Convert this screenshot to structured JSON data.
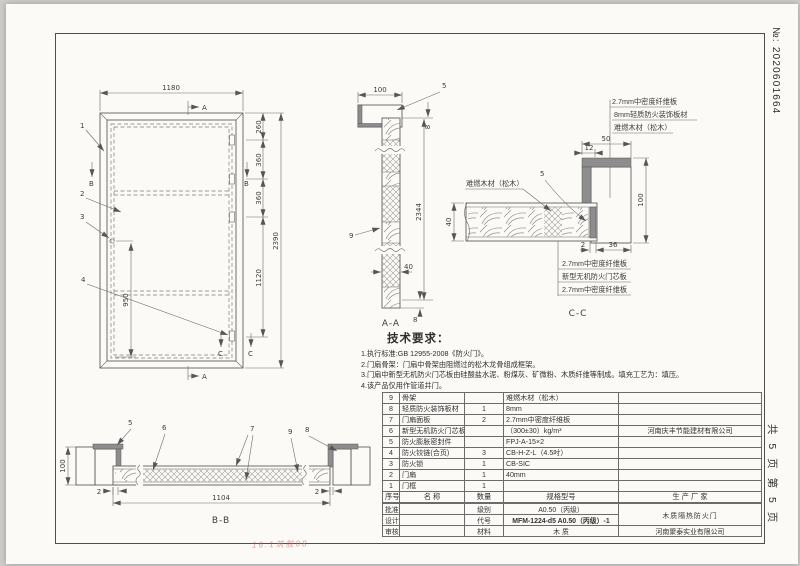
{
  "meta": {
    "doc_no": "№: 2020601664",
    "page_info": "共 5 页  第 5 页",
    "note": "16.1筑胶08"
  },
  "elev": {
    "w": "1180",
    "h": "2390",
    "s1": "260",
    "s2": "360",
    "s3": "360",
    "s4": "1120",
    "lock": "950",
    "n1": "1",
    "n2": "2",
    "n3": "3",
    "n4": "4",
    "a": "A",
    "b": "B",
    "c": "C"
  },
  "aa": {
    "label": "A-A",
    "w": "100",
    "h": "2344",
    "t": "40",
    "gap": "8",
    "n5": "5",
    "n9": "9"
  },
  "cc": {
    "label": "C-C",
    "top1": "2.7mm中密度纤维板",
    "top2": "8mm轻质防火装饰板材",
    "top3": "难燃木材（松木）",
    "left": "难燃木材（松木）",
    "bot1": "2.7mm中密度纤维板",
    "bot2": "新型无机防火门芯板",
    "bot3": "2.7mm中密度纤维板",
    "d50": "50",
    "d12": "12",
    "d100": "100",
    "d40": "40",
    "d2": "2",
    "d36": "36",
    "n5": "5"
  },
  "bb": {
    "label": "B-B",
    "d100": "100",
    "d2l": "2",
    "d2r": "2",
    "d1104": "1104",
    "n5": "5",
    "n6": "6",
    "n7": "7",
    "n8": "8",
    "n9": "9"
  },
  "tech": {
    "title": "技术要求：",
    "items": [
      "1.执行标准:GB 12955-2008《防火门》。",
      "2.门扇骨架：门扇中骨架由阻燃过的松木龙骨组成框架。",
      "3.门扇中新型无机防火门芯板由硅酸盐水泥、粉煤灰、矿微粉、木质纤维等制成。填充工艺为：填压。",
      "4.该产品仅用作管道井门。"
    ]
  },
  "parts": {
    "h_no": "序号",
    "h_name": "名  称",
    "h_qty": "数量",
    "h_spec": "规格型号",
    "h_mfr": "生 产 厂 家",
    "rows": [
      {
        "no": "9",
        "name": "骨架",
        "qty": "",
        "spec": "难燃木材（松木）",
        "mfr": ""
      },
      {
        "no": "8",
        "name": "轻质防火装饰板材",
        "qty": "1",
        "spec": "8mm",
        "mfr": ""
      },
      {
        "no": "7",
        "name": "门扇面板",
        "qty": "2",
        "spec": "2.7mm中密度纤维板",
        "mfr": ""
      },
      {
        "no": "6",
        "name": "新型无机防火门芯板",
        "qty": "",
        "spec": "（300±30）kg/m³",
        "mfr": "河南庆丰节能建材有限公司"
      },
      {
        "no": "5",
        "name": "防火膨胀密封件",
        "qty": "",
        "spec": "FPJ-A-15×2",
        "mfr": ""
      },
      {
        "no": "4",
        "name": "防火铰链(合页)",
        "qty": "3",
        "spec": "CB-H-Z-L（4.5吋）",
        "mfr": ""
      },
      {
        "no": "3",
        "name": "防火锁",
        "qty": "1",
        "spec": "CB-SIC",
        "mfr": ""
      },
      {
        "no": "2",
        "name": "门扇",
        "qty": "1",
        "spec": "40mm",
        "mfr": ""
      },
      {
        "no": "1",
        "name": "门框",
        "qty": "1",
        "spec": "",
        "mfr": ""
      }
    ]
  },
  "tb": {
    "approve": "批准",
    "design": "设计",
    "review": "审核",
    "grade_l": "级别",
    "grade_v": "A0.50（丙级）",
    "code_l": "代号",
    "code_v": "MFM-1224-d5 A0.50（丙级）-1",
    "mat_l": "材料",
    "mat_v": "木  质",
    "product": "木质隔热防火门",
    "company": "河南聚泰实业有限公司"
  }
}
